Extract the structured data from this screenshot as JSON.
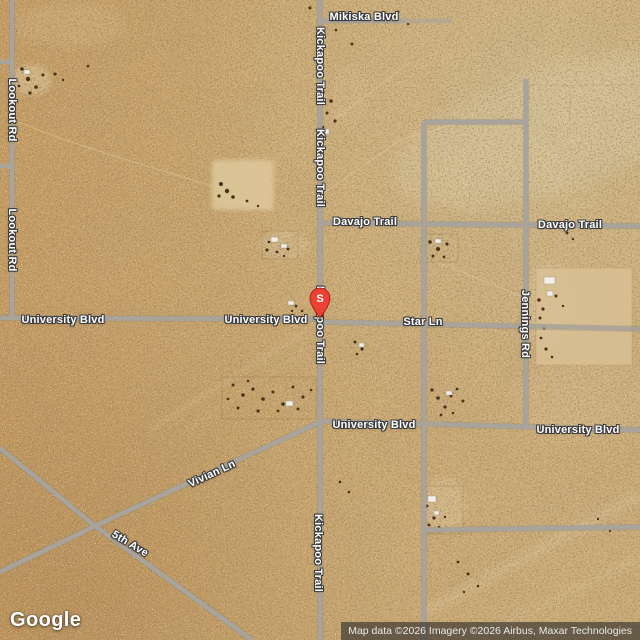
{
  "map": {
    "marker": {
      "label": "S"
    },
    "road_names": {
      "mikiska": "Mikiska Blvd",
      "kickapoo": "Kickapoo Trail",
      "lookout": "Lookout Rd",
      "davajo": "Davajo Trail",
      "university": "University Blvd",
      "star": "Star Ln",
      "jennings": "Jennings Rd",
      "vivian": "Vivian Ln",
      "fifth": "5th Ave"
    }
  },
  "footer": {
    "logo_text": "Google",
    "attribution": "Map data ©2026 Imagery ©2026 Airbus, Maxar Technologies"
  },
  "colors": {
    "marker_red": "#EA4335",
    "marker_stroke": "#A50E0E",
    "road_gray": "#a8a49c"
  }
}
